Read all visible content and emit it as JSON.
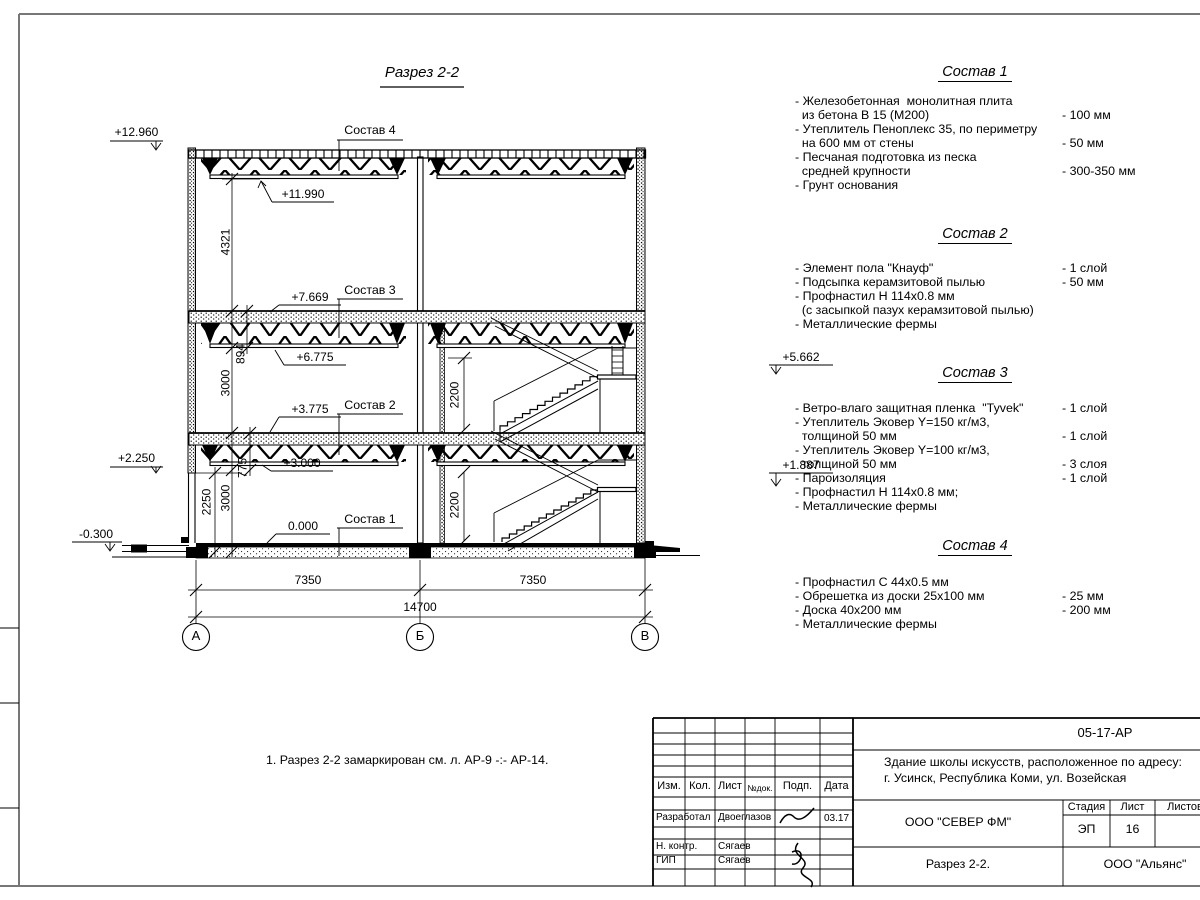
{
  "sheet": {
    "title": "Разрез 2-2",
    "note": "1. Разрез 2-2 замаркирован см. л. АР-9 -:- АР-14."
  },
  "marks": {
    "m12_960": "+12.960",
    "m11_990": "+11.990",
    "m7_669": "+7.669",
    "m6_775": "+6.775",
    "m5_662": "+5.662",
    "m3_775": "+3.775",
    "m3_000": "+3.000",
    "m2_250": "+2.250",
    "m1_887": "+1.887",
    "m0_000": "0.000",
    "mneg0_300": "-0.300"
  },
  "dims": {
    "v4321": "4321",
    "v894": "894",
    "v3000_upper": "3000",
    "v775": "775",
    "v3000_lower": "3000",
    "v2250": "2250",
    "v2200_upper": "2200",
    "v2200_lower": "2200",
    "h7350_left": "7350",
    "h7350_right": "7350",
    "h14700": "14700"
  },
  "callouts": {
    "c4": "Состав 4",
    "c3": "Состав 3",
    "c2": "Состав 2",
    "c1": "Состав 1"
  },
  "axes": {
    "a": "А",
    "b": "Б",
    "v": "В"
  },
  "specs": [
    {
      "title": "Состав 1",
      "rows": [
        {
          "t": "- Железобетонная  монолитная плита",
          "v": ""
        },
        {
          "t": "  из бетона В 15 (М200)",
          "v": "- 100 мм"
        },
        {
          "t": "- Утеплитель Пеноплекс 35, по периметру",
          "v": ""
        },
        {
          "t": "  на 600 мм от стены",
          "v": "- 50 мм"
        },
        {
          "t": "- Песчаная подготовка из песка",
          "v": ""
        },
        {
          "t": "  средней крупности",
          "v": "- 300-350 мм"
        },
        {
          "t": "- Грунт основания",
          "v": ""
        }
      ]
    },
    {
      "title": "Состав 2",
      "rows": [
        {
          "t": "- Элемент пола \"Кнауф\"",
          "v": "- 1 слой"
        },
        {
          "t": "- Подсыпка керамзитовой пылью",
          "v": "- 50 мм"
        },
        {
          "t": "- Профнастил Н 114х0.8 мм",
          "v": ""
        },
        {
          "t": "  (с засыпкой пазух керамзитовой пылью)",
          "v": ""
        },
        {
          "t": "- Металлические фермы",
          "v": ""
        }
      ]
    },
    {
      "title": "Состав 3",
      "rows": [
        {
          "t": "- Ветро-влаго защитная пленка  \"Tyvek\"",
          "v": "- 1 слой"
        },
        {
          "t": "- Утеплитель Эковер Y=150 кг/м3,",
          "v": ""
        },
        {
          "t": "  толщиной 50 мм",
          "v": "- 1 слой"
        },
        {
          "t": "- Утеплитель Эковер Y=100 кг/м3,",
          "v": ""
        },
        {
          "t": "  толщиной 50 мм",
          "v": "- 3 слоя"
        },
        {
          "t": "- Пароизоляция",
          "v": "- 1 слой"
        },
        {
          "t": "- Профнастил Н 114х0.8 мм;",
          "v": ""
        },
        {
          "t": "- Металлические фермы",
          "v": ""
        }
      ]
    },
    {
      "title": "Состав 4",
      "rows": [
        {
          "t": "- Профнастил С 44х0.5 мм",
          "v": ""
        },
        {
          "t": "- Обрешетка из доски 25х100 мм",
          "v": "- 25 мм"
        },
        {
          "t": "- Доска 40х200 мм",
          "v": "- 200 мм"
        },
        {
          "t": "- Металлические фермы",
          "v": ""
        }
      ]
    }
  ],
  "titleblock": {
    "doc_number": "05-17-АР",
    "project_line1": "Здание школы искусств, расположенное по адресу:",
    "project_line2": "г. Усинск, Республика Коми, ул. Возейская",
    "col_izm": "Изм.",
    "col_kol": "Кол.",
    "col_list": "Лист",
    "col_ndok": "№док.",
    "col_podp": "Подп.",
    "col_data": "Дата",
    "row1_role": "Разработал",
    "row1_name": "Двоеглазов",
    "row1_date": "03.17",
    "row2_role": "Н. контр.",
    "row2_name": "Сягаев",
    "row3_role": "ГИП",
    "row3_name": "Сягаев",
    "org": "ООО \"СЕВЕР ФМ\"",
    "stage_label": "Стадия",
    "sheet_label": "Лист",
    "sheets_label": "Листов",
    "stage": "ЭП",
    "sheet_num": "16",
    "sheet_title": "Разрез 2-2.",
    "contractor": "ООО \"Альянс\""
  }
}
